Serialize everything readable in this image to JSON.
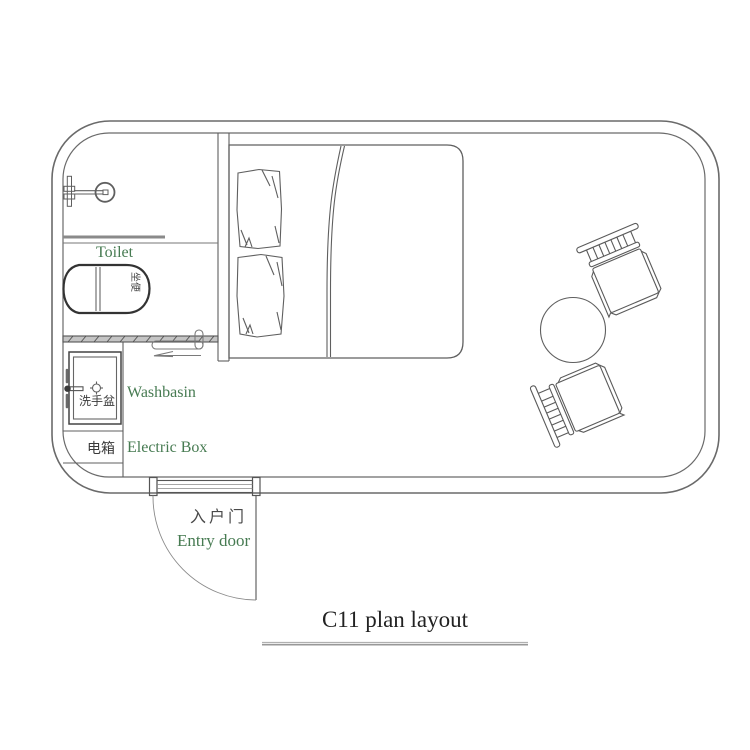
{
  "title": "C11 plan layout",
  "labels": {
    "toilet": "Toilet",
    "toilet_zh": "坐便",
    "washbasin": "Washbasin",
    "washbasin_zh": "洗手盆",
    "electric_box": "Electric Box",
    "electric_box_zh": "电箱",
    "entry_door": "Entry door",
    "entry_door_zh": "入户门"
  },
  "colors": {
    "label_green": "#477B52",
    "line_gray": "#5f5f5f",
    "toilet_outline": "#333333",
    "title_text": "#222222"
  },
  "plan_items": [
    "room outline with rounded corners (double wall line)",
    "bathroom with shower head, glass partition, toilet",
    "sliding bathroom door with direction arrow",
    "washbasin with wall tap",
    "electric box compartment",
    "entry door with frame and quarter-circle swing arc",
    "double bed with two pillows and blanket fold",
    "round table",
    "two slat-back chairs"
  ]
}
